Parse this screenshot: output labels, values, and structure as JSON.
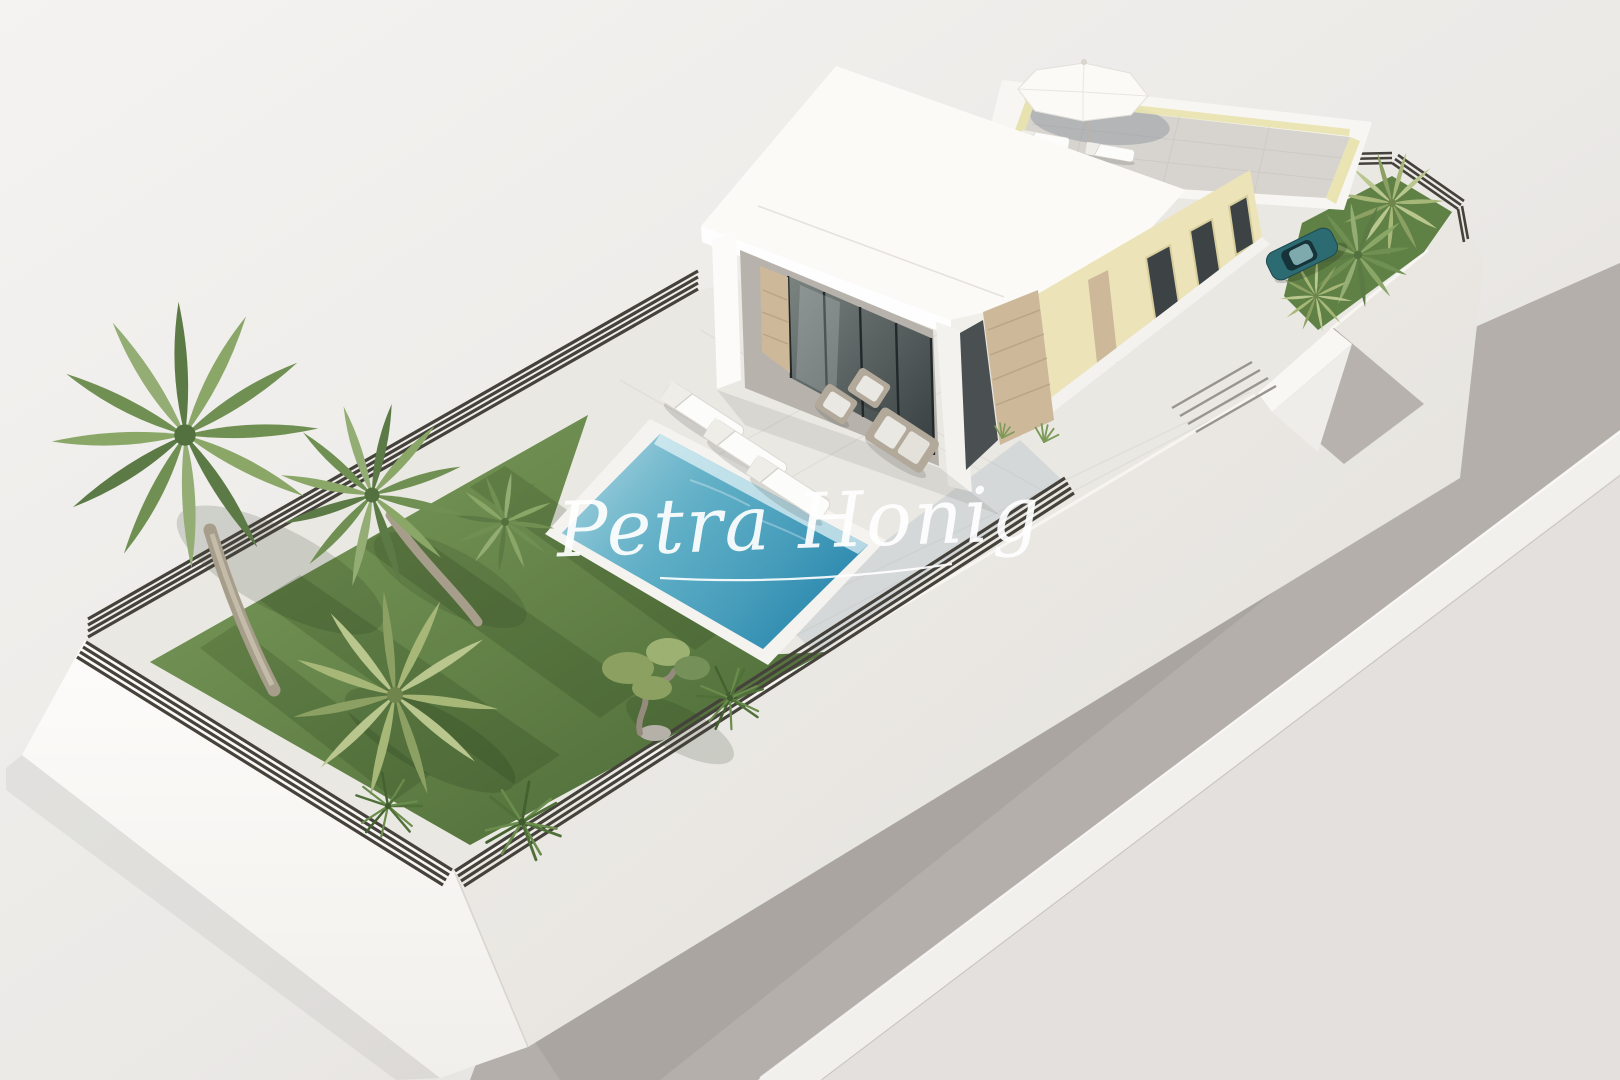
{
  "watermark": {
    "text": "Petra Honig"
  },
  "scene": {
    "type": "3d-architectural-render",
    "subject": "aerial view of a modern white villa plot with pool, lawn garden, rooftop solarium and street",
    "colors": {
      "background": "#f0eeec",
      "road": "#b4afab",
      "curb": "#f2f0ed",
      "wall_white": "#f7f5f2",
      "terrace_tile": "#eae8e3",
      "lawn": "#6b8c4e",
      "fence": "#45413b",
      "pool_water": "#54a8c2",
      "pool_coping": "#f4f3ef",
      "stone": "#cdb89a",
      "facade_yellow": "#ece4b8",
      "glass": "#3e4546",
      "balustrade_yellow": "#e9e3ae",
      "car": "#2d6b72"
    },
    "objects": {
      "pools": 1,
      "poolside_loungers": 3,
      "outdoor_sofas": 3,
      "rooftop_loungers": 2,
      "parasols": 1,
      "cars": 1,
      "palm_trees": 7,
      "olive_trees": 1,
      "shrubs": 3
    }
  }
}
